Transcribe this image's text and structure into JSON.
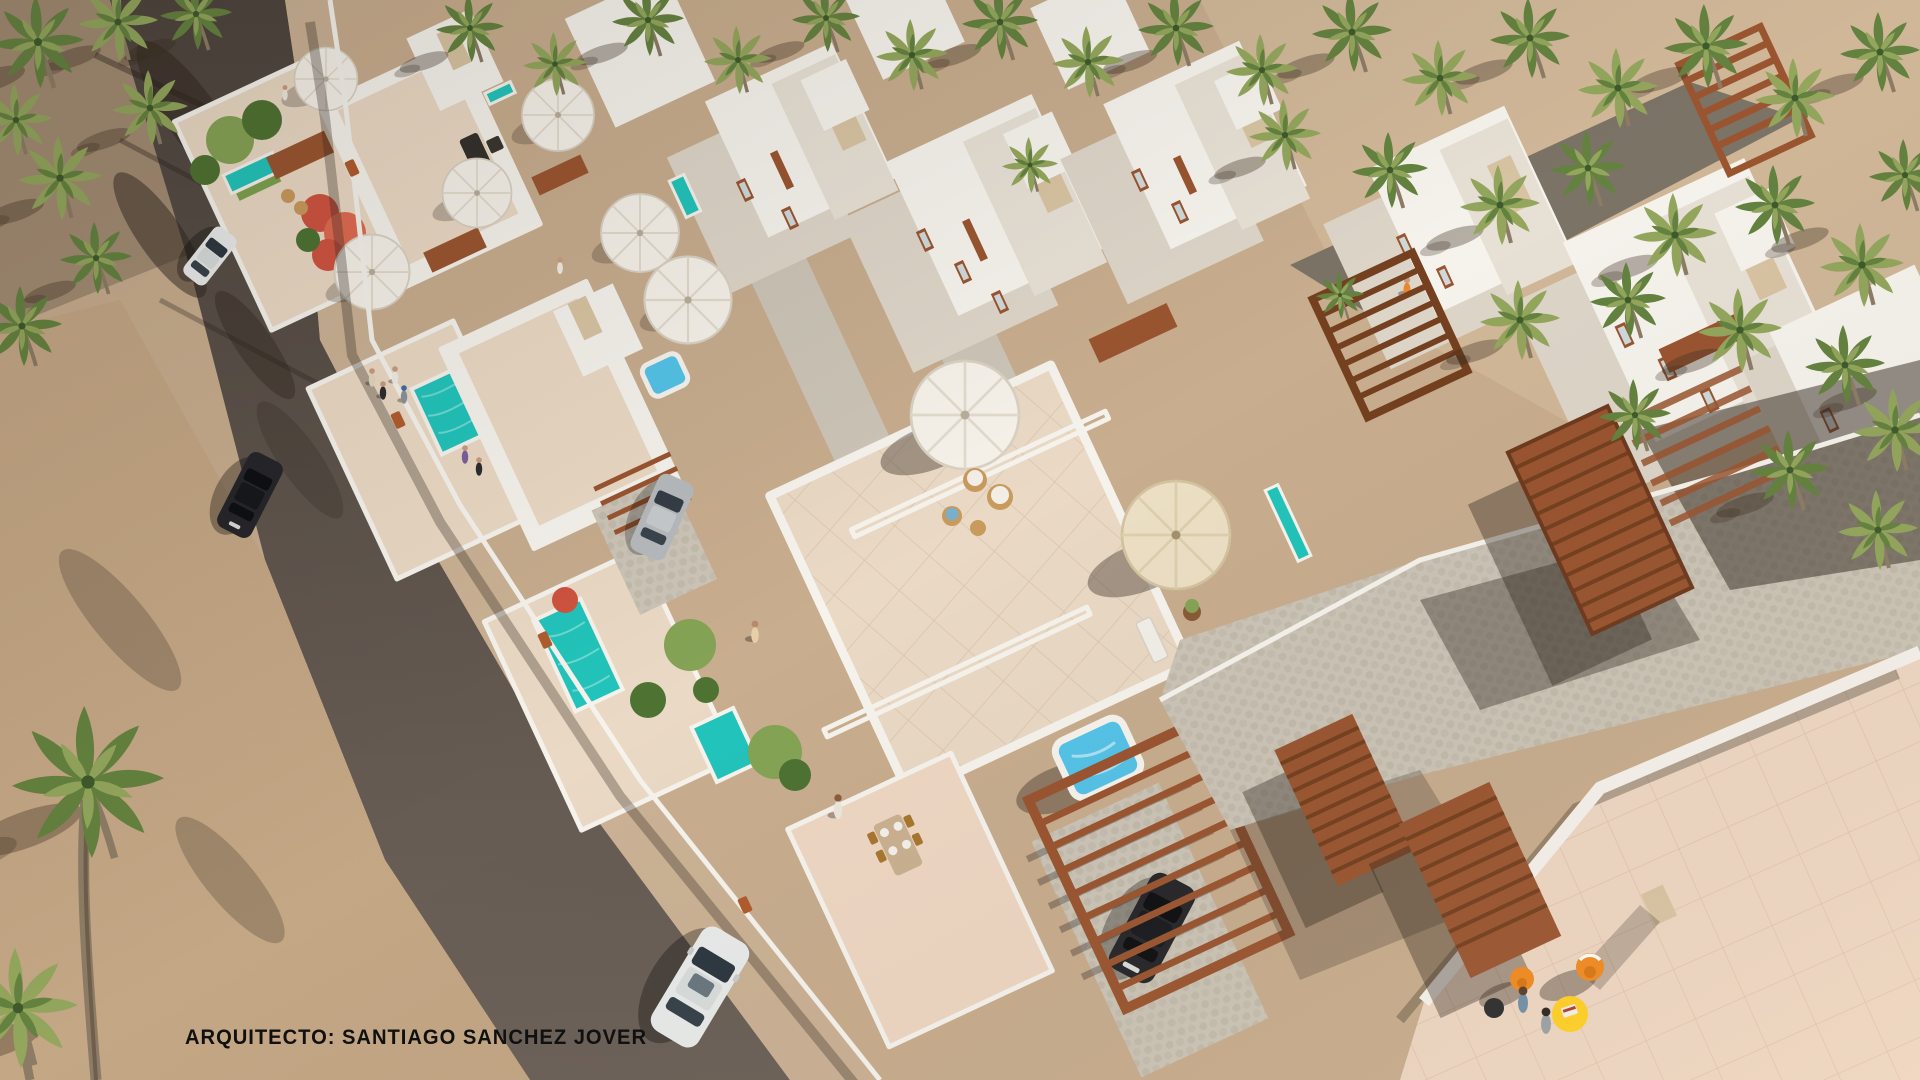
{
  "image": {
    "kind": "3d-architectural-render",
    "view": "aerial",
    "width": 1920,
    "height": 1080
  },
  "watermark": {
    "text": "ARQUITECTO: SANTIAGO SANCHEZ JOVER"
  },
  "palette": {
    "sand": "#c8ad8e",
    "sandShade": "#9b8168",
    "brick": "#c4a785",
    "sidewalk": "#cbb295",
    "road": "#5e544c",
    "roadDark": "#473f39",
    "roadBack": "#7c7367",
    "white": "#f6f3ed",
    "whiteShade": "#e7e0d5",
    "faceShade": "#ddd5c8",
    "terrace": "#ead9c4",
    "terracePink": "#eed7c3",
    "cobble": "#ccc5b7",
    "cobbleDark": "#b9b1a1",
    "wood": "#9a5530",
    "woodDark": "#74401f",
    "pool": "#22c4bb",
    "jacuzzi": "#54c3e8",
    "lawn": "#7ba24f",
    "treeDark": "#4d7232",
    "treeLight": "#85a355",
    "palm": "#64823f",
    "palmLight": "#93a65c",
    "trunk": "#8d7c65",
    "flower": "#cf5340",
    "panel": "#d8c4a2",
    "umbrella": "#f6f2ea",
    "umbrellaBeige": "#ecdfc4",
    "orange": "#f18a1f",
    "yellow": "#ffd024",
    "carWhite": "#e9ebea",
    "carSilver": "#b6babd",
    "carBlack": "#26262a",
    "text": "#101010"
  },
  "scene": {
    "environment": {
      "ground": "sand",
      "palm_trees": 46,
      "flowering_trees": 2
    },
    "street": {
      "surface": "asphalt",
      "sidewalk": "brick pavers",
      "plaza": "brick paver esplanade"
    },
    "vehicles": {
      "driving": [
        {
          "color": "white"
        },
        {
          "color": "black"
        },
        {
          "color": "white"
        }
      ],
      "parked": [
        {
          "color": "silver"
        },
        {
          "color": "black"
        }
      ]
    },
    "buildings": {
      "style": "whitewashed cubic villas",
      "rows": 2,
      "accents": [
        "terracotta pergolas",
        "timber staircases",
        "beige stone panels",
        "terracotta window frames"
      ]
    },
    "amenities": {
      "garden_pools": 4,
      "rooftop_plunge_pools": 3,
      "jacuzzis": 2,
      "white_parasols": 7,
      "beige_parasols": 1,
      "sun_loungers": 2,
      "orange_chairs": 2,
      "yellow_table": 1,
      "dining_sets": 3
    },
    "people": 14
  }
}
